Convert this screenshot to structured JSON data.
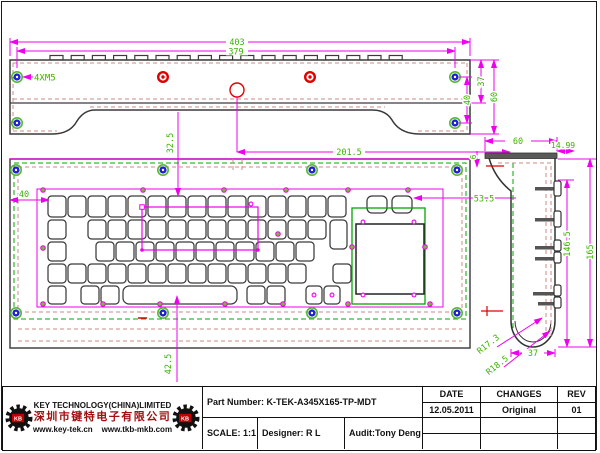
{
  "title_block": {
    "company": "KEY TECHNOLOGY(CHINA)LIMITED",
    "company_cn": "深圳市键特电子有限公司",
    "url1": "www.key-tek.cn",
    "url2": "www.tkb-mkb.com",
    "logo_text": "KB",
    "part": "Part Number: K-TEK-A345X165-TP-MDT",
    "scale": "SCALE: 1:1",
    "designer": "Designer: R L",
    "audit": "Audit:Tony Deng",
    "h_date": "DATE",
    "h_changes": "CHANGES",
    "h_rev": "REV",
    "v_date": "12.05.2011",
    "v_changes": "Original",
    "v_rev": "01"
  },
  "dims": {
    "overall_width": "403",
    "hole_span": "379",
    "hole_note": "4XM5",
    "right_inner": "40",
    "right_mid": "37",
    "right_outer": "60",
    "center_offset": "201.5",
    "top_gap": "32.5",
    "left_margin": "40",
    "pad_offset": "53.5",
    "bottom_gap": "42.5",
    "side_depth": "60",
    "key_height": "14.99",
    "lip": "6",
    "front_height": "146.5",
    "total_height": "165",
    "radius_inner": "R17.3",
    "radius_outer": "R18.5",
    "bottom_width": "37"
  },
  "drawing": {
    "colors": {
      "dim_line": "#EE00EE",
      "dim_text": "#3BB300",
      "outline": "#3A3A3A",
      "dash_green": "#00A800",
      "dash_pink": "#CC8A8A",
      "screw_blue": "#2020D0",
      "ring_green": "#55B833",
      "red": "#E00000",
      "dot_green": "#77BB33"
    },
    "top_view": {
      "tabs": {
        "start": 50,
        "count": 17,
        "pitch": 21.2,
        "width": 13,
        "y": 55.5,
        "h": 4.5
      },
      "screws": [
        [
          17,
          77
        ],
        [
          17,
          123
        ],
        [
          455,
          77
        ],
        [
          455,
          123
        ]
      ],
      "red_donuts": [
        [
          163,
          77
        ],
        [
          310,
          77
        ]
      ],
      "center_circle": [
        237,
        90
      ]
    },
    "front_view": {
      "screws": [
        [
          16,
          170
        ],
        [
          163,
          170
        ],
        [
          312,
          170
        ],
        [
          457,
          170
        ],
        [
          16,
          313
        ],
        [
          163,
          313
        ],
        [
          312,
          313
        ],
        [
          457,
          313
        ]
      ],
      "green_dots": [
        [
          43,
          190
        ],
        [
          143,
          190
        ],
        [
          224,
          190
        ],
        [
          286,
          190
        ],
        [
          348,
          190
        ],
        [
          408,
          190
        ],
        [
          43,
          304
        ],
        [
          103,
          304
        ],
        [
          160,
          304
        ],
        [
          225,
          304
        ],
        [
          283,
          304
        ],
        [
          348,
          304
        ],
        [
          430,
          304
        ],
        [
          43,
          248
        ],
        [
          278,
          234
        ],
        [
          352,
          247
        ],
        [
          425,
          247
        ]
      ],
      "open_dots": [
        [
          363,
          222
        ],
        [
          414,
          222
        ],
        [
          363,
          295
        ],
        [
          414,
          295
        ],
        [
          251,
          204
        ],
        [
          314,
          295
        ],
        [
          332,
          295
        ]
      ],
      "mag_dots": [
        [
          142,
          250
        ],
        [
          258,
          250
        ]
      ],
      "key_rows": [
        {
          "y": 196,
          "h": 21,
          "rx": 3.5,
          "keys": [
            [
              48,
              18
            ],
            [
              68,
              18
            ],
            [
              88,
              18
            ],
            [
              108,
              18
            ],
            [
              128,
              18
            ],
            [
              148,
              18
            ],
            [
              168,
              18
            ],
            [
              188,
              18
            ],
            [
              208,
              18
            ],
            [
              228,
              18
            ],
            [
              248,
              18
            ],
            [
              268,
              18
            ],
            [
              288,
              18
            ],
            [
              308,
              18
            ],
            [
              328,
              18
            ]
          ]
        },
        {
          "y": 196,
          "h": 17,
          "rx": 5,
          "keys": [
            [
              367,
              20
            ],
            [
              392,
              20
            ]
          ]
        },
        {
          "y": 220,
          "h": 19,
          "rx": 3.5,
          "keys": [
            [
              48,
              18
            ],
            [
              88,
              18
            ],
            [
              108,
              18
            ],
            [
              128,
              18
            ],
            [
              148,
              18
            ],
            [
              168,
              18
            ],
            [
              188,
              18
            ],
            [
              208,
              18
            ],
            [
              228,
              18
            ],
            [
              248,
              18
            ],
            [
              268,
              18
            ],
            [
              288,
              18
            ],
            [
              308,
              18
            ]
          ]
        },
        {
          "y": 220,
          "h": 29,
          "rx": 4,
          "keys": [
            [
              330,
              17
            ]
          ]
        },
        {
          "y": 242,
          "h": 19,
          "rx": 3.5,
          "keys": [
            [
              48,
              18
            ],
            [
              96,
              18
            ],
            [
              116,
              18
            ],
            [
              136,
              18
            ],
            [
              156,
              18
            ],
            [
              176,
              18
            ],
            [
              196,
              18
            ],
            [
              216,
              18
            ],
            [
              236,
              18
            ],
            [
              256,
              18
            ],
            [
              276,
              18
            ],
            [
              296,
              18
            ]
          ]
        },
        {
          "y": 264,
          "h": 19,
          "rx": 3.5,
          "keys": [
            [
              48,
              18
            ],
            [
              68,
              18
            ],
            [
              88,
              18
            ],
            [
              108,
              18
            ],
            [
              128,
              18
            ],
            [
              148,
              18
            ],
            [
              168,
              18
            ],
            [
              188,
              18
            ],
            [
              208,
              18
            ],
            [
              228,
              18
            ],
            [
              248,
              18
            ],
            [
              268,
              18
            ],
            [
              288,
              18
            ],
            [
              333,
              18
            ]
          ]
        },
        {
          "y": 286,
          "h": 18,
          "rx": 3.5,
          "keys": [
            [
              48,
              18
            ],
            [
              81,
              18
            ],
            [
              101,
              18
            ],
            [
              247,
              18
            ],
            [
              267,
              18
            ],
            [
              306,
              16
            ],
            [
              324,
              16
            ]
          ]
        },
        {
          "y": 286,
          "h": 18,
          "rx": 6,
          "keys": [
            [
              123,
              114
            ]
          ]
        }
      ]
    },
    "side_view": {
      "nub_stems": [
        [
          535,
          187
        ],
        [
          535,
          218
        ],
        [
          535,
          246
        ],
        [
          535,
          257
        ],
        [
          533,
          292
        ],
        [
          538,
          302
        ]
      ],
      "nub_caps": [
        [
          554,
          181,
          15
        ],
        [
          554,
          211,
          16
        ],
        [
          554,
          240,
          11
        ],
        [
          554,
          252,
          11
        ],
        [
          554,
          285,
          11
        ],
        [
          554,
          297,
          11
        ]
      ]
    }
  }
}
